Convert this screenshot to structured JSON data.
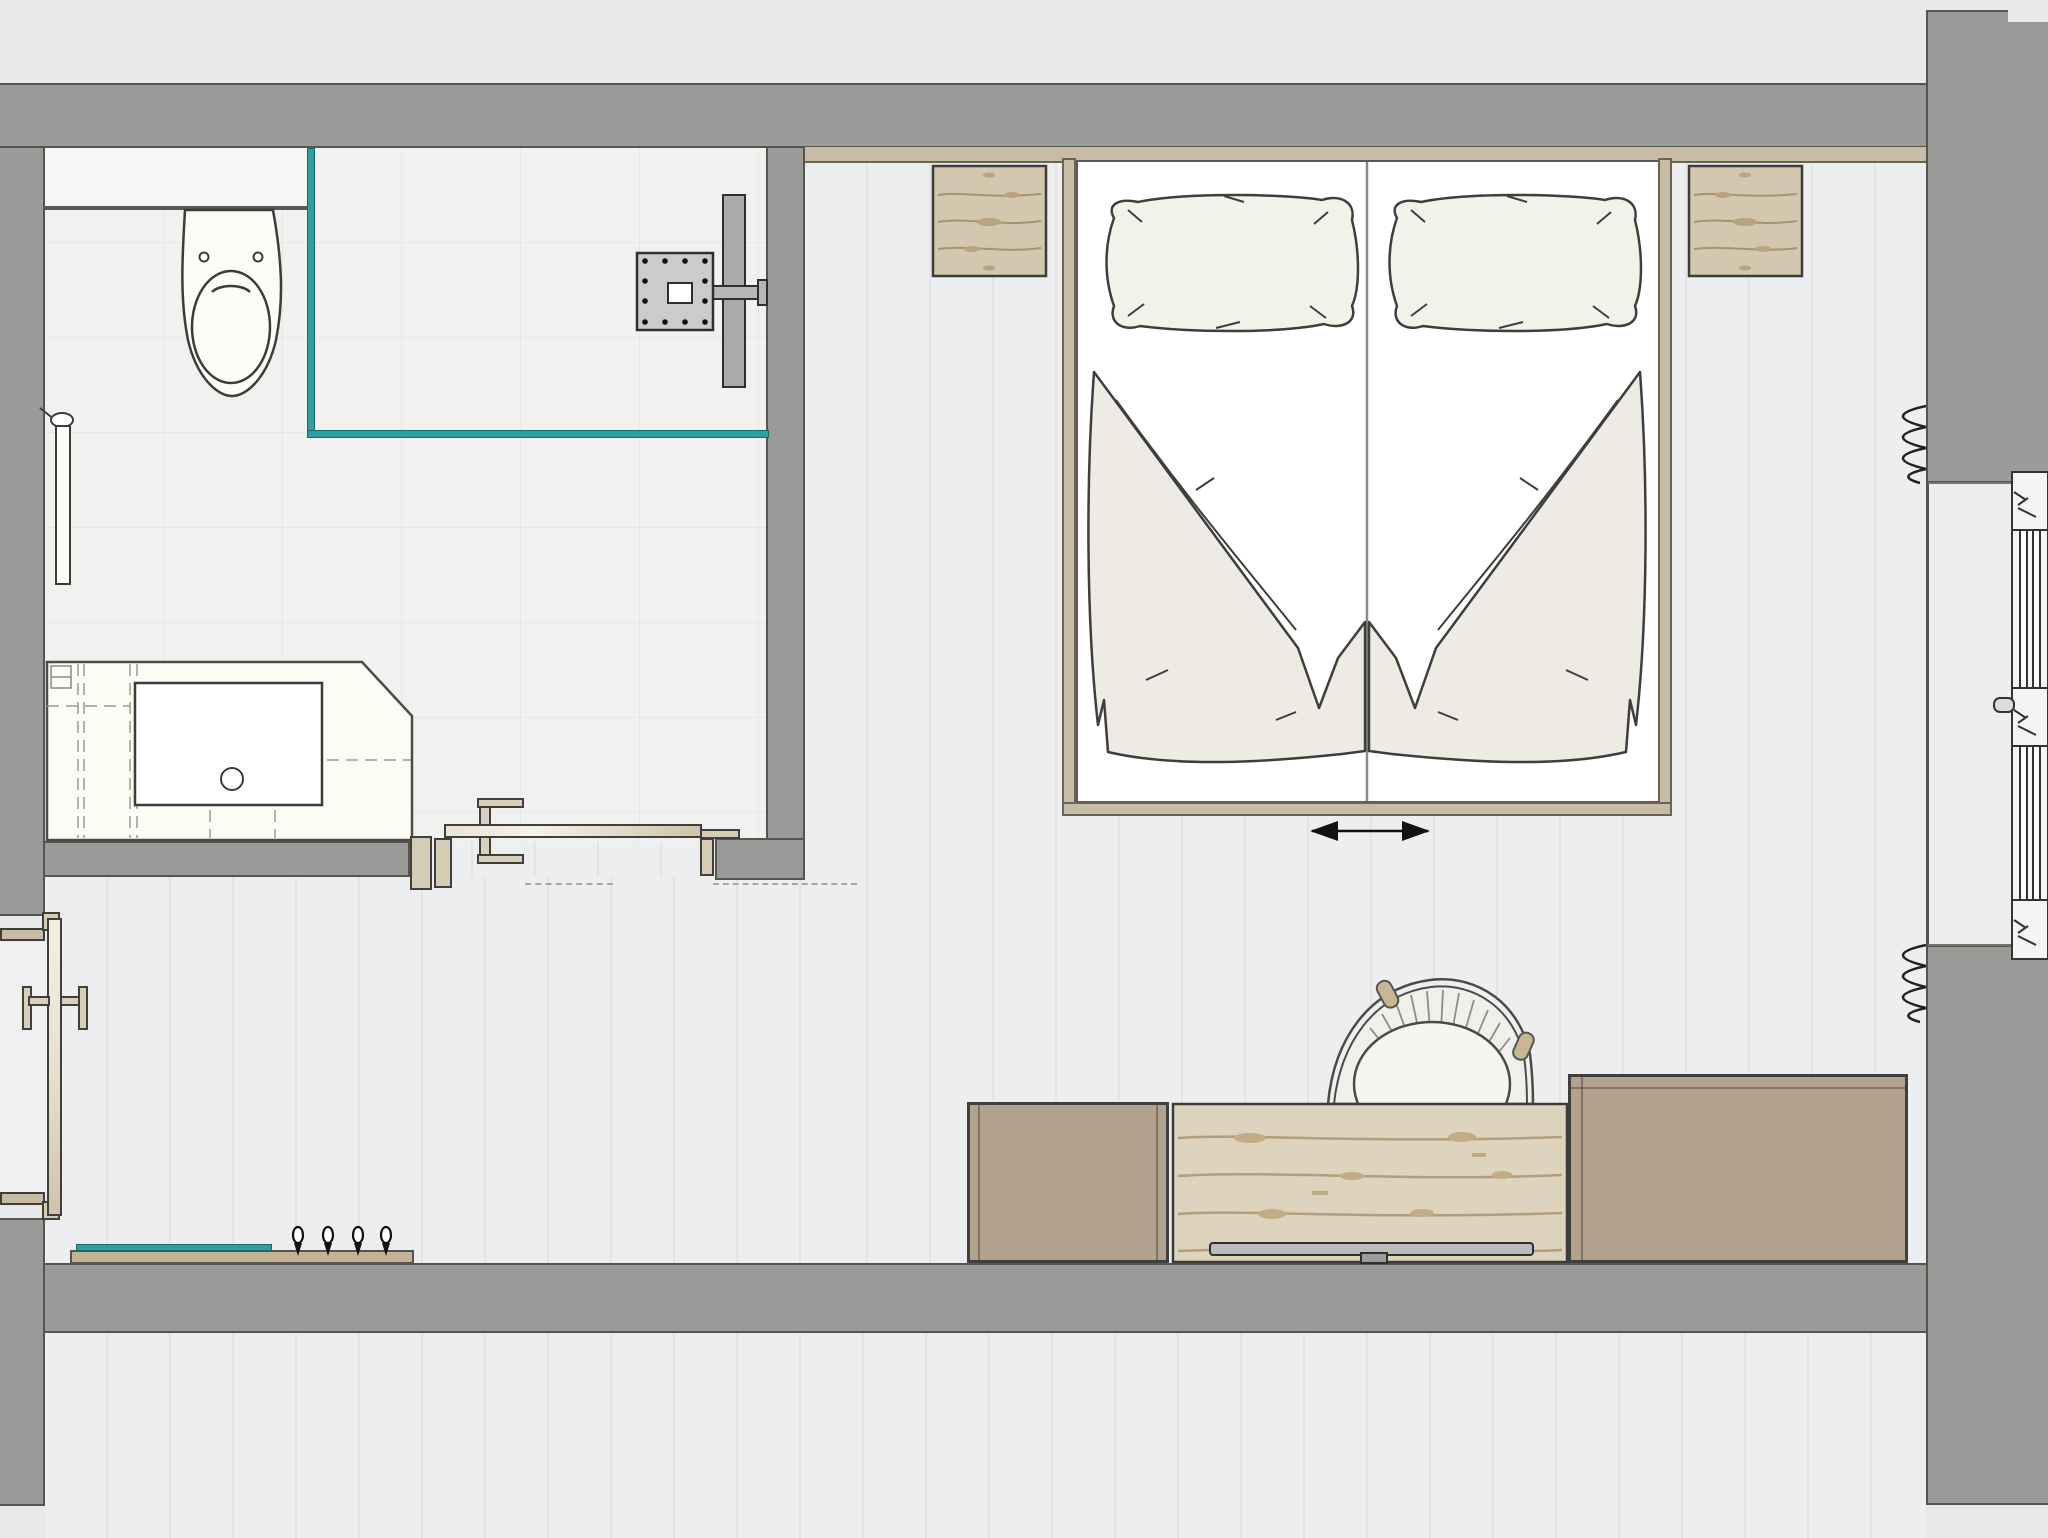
{
  "page": {
    "title": "Hotel guest room floor plan",
    "view": "top-down architectural plan",
    "text_labels": []
  },
  "palette": {
    "exterior": "#e8e9eb",
    "wall": "#9a9b99",
    "wallline": "#55544f",
    "line": "#3f3f3d",
    "floor": "#edeef0",
    "floorstreak": "#e2e4e6",
    "bathfloor": "#f1f1ef",
    "bathledge": "#f6f6f4",
    "tileline": "#e7e7e5",
    "glass": "#2d9fa0",
    "woodband": "#c9bca6",
    "woodgrain": "#a5926f",
    "nightstand": "#d3c7af",
    "cabinet": "#b2a18c",
    "counter": "#ded3bd",
    "frametan": "#d6cbb4",
    "bedding": "#edebe4",
    "sheet": "#ffffff",
    "fixture": "#c9cccb",
    "fixturedark": "#a9acab",
    "tray": "#b9bcbb"
  },
  "rooms": [
    {
      "name": "bathroom",
      "fixtures": [
        "toilet",
        "walk-in shower",
        "rain shower head",
        "glass shower screen",
        "vanity with basin",
        "towel rail"
      ]
    },
    {
      "name": "bedroom",
      "furniture": [
        "double bed",
        "two pillows",
        "two folded duvets",
        "left nightstand",
        "right nightstand",
        "armchair",
        "desk counter with pencil tray",
        "sideboard cabinet left",
        "sideboard cabinet right",
        "window with radiator coils"
      ]
    },
    {
      "name": "entry-hall",
      "furniture": [
        "entry door",
        "bathroom door",
        "coat rack with 4 hooks"
      ]
    },
    {
      "name": "adjacent-room-below",
      "furniture": []
    }
  ],
  "counts": {
    "pillows": 2,
    "duvets": 2,
    "nightstands": 2,
    "coat_hooks": 4,
    "windows": 1,
    "doors": 2,
    "radiator_coils": 2
  },
  "symbols": {
    "bed_slide_arrow": "double-headed horizontal arrow below bed",
    "insulation_coil": "zigzag spring at window jambs"
  }
}
